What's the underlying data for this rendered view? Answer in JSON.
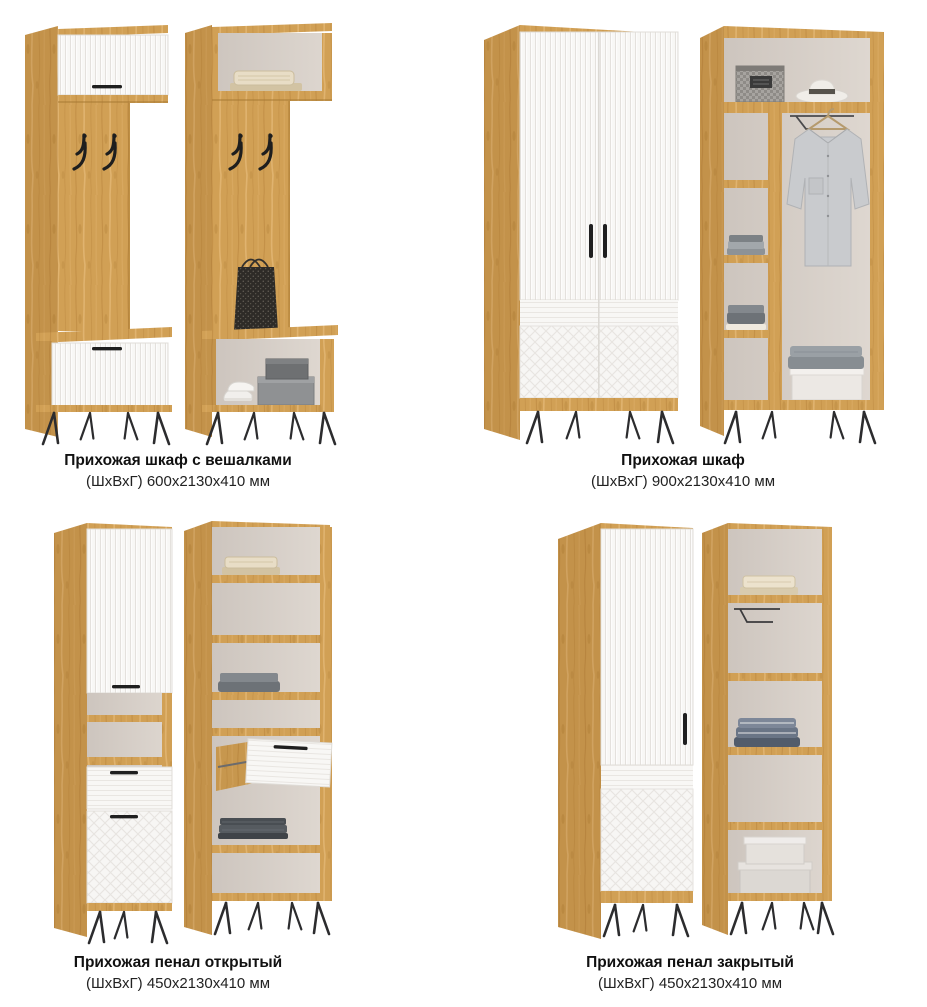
{
  "page": {
    "background_color": "#ffffff"
  },
  "palette": {
    "wood": "#d1a055",
    "wood_shadow": "#b07f3a",
    "door_white": "#f8f7f5",
    "interior_back": "#d8d1ca",
    "metal_black": "#2c2c2e",
    "text": "#111111"
  },
  "catalog": {
    "items": [
      {
        "title": "Прихожая шкаф с вешалками",
        "dimensions": "(ШхВхГ) 600х2130х410 мм"
      },
      {
        "title": "Прихожая шкаф",
        "dimensions": "(ШхВхГ) 900х2130х410 мм"
      },
      {
        "title": "Прихожая пенал открытый",
        "dimensions": "(ШхВхГ) 450х2130х410 мм"
      },
      {
        "title": "Прихожая пенал закрытый",
        "dimensions": "(ШхВхГ) 450х2130х410 мм"
      }
    ]
  }
}
